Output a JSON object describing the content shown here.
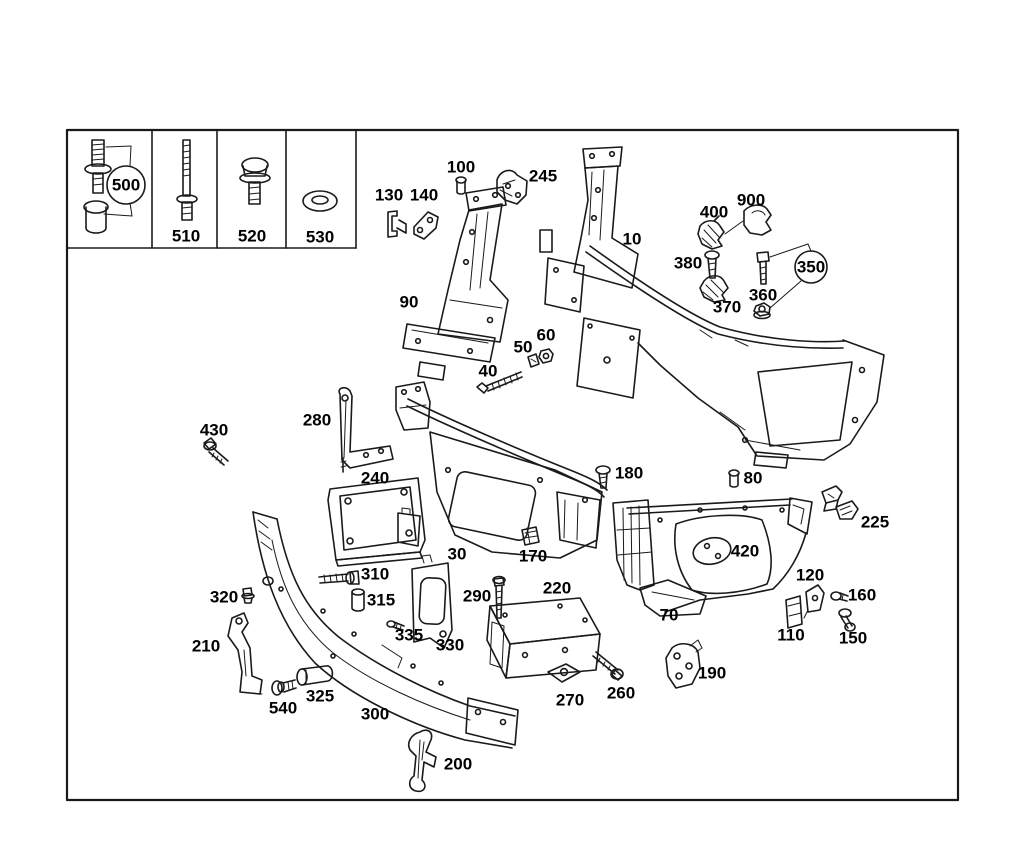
{
  "document": {
    "kind": "vehicle-parts-exploded-diagram",
    "subject": "front end / radiator support and bumper reinforcement parts"
  },
  "colors": {
    "background": "#ffffff",
    "line": "#1a1a1a",
    "accent_red": "#e5173f",
    "label_text": "#000000"
  },
  "legend": {
    "cells": [
      {
        "callout": "500",
        "icon": "stud-and-cap-nut-icon",
        "circled": true
      },
      {
        "callout": "510",
        "icon": "long-collar-bolt-icon"
      },
      {
        "callout": "520",
        "icon": "hex-flange-bolt-icon"
      },
      {
        "callout": "530",
        "icon": "washer-icon"
      }
    ]
  },
  "callouts": [
    {
      "label": "500",
      "x": 126,
      "y": 185,
      "circled": true
    },
    {
      "label": "510",
      "x": 186,
      "y": 236
    },
    {
      "label": "520",
      "x": 252,
      "y": 236
    },
    {
      "label": "530",
      "x": 320,
      "y": 237
    },
    {
      "label": "100",
      "x": 461,
      "y": 167
    },
    {
      "label": "245",
      "x": 543,
      "y": 176
    },
    {
      "label": "130",
      "x": 389,
      "y": 195
    },
    {
      "label": "140",
      "x": 424,
      "y": 195
    },
    {
      "label": "10",
      "x": 632,
      "y": 239
    },
    {
      "label": "90",
      "x": 409,
      "y": 302
    },
    {
      "label": "900",
      "x": 751,
      "y": 200
    },
    {
      "label": "400",
      "x": 714,
      "y": 212
    },
    {
      "label": "380",
      "x": 688,
      "y": 263
    },
    {
      "label": "370",
      "x": 727,
      "y": 307
    },
    {
      "label": "360",
      "x": 763,
      "y": 295
    },
    {
      "label": "350",
      "x": 811,
      "y": 267,
      "circled": true
    },
    {
      "label": "50",
      "x": 523,
      "y": 347
    },
    {
      "label": "60",
      "x": 546,
      "y": 335
    },
    {
      "label": "40",
      "x": 488,
      "y": 371
    },
    {
      "label": "430",
      "x": 214,
      "y": 430
    },
    {
      "label": "280",
      "x": 317,
      "y": 420
    },
    {
      "label": "240",
      "x": 375,
      "y": 478
    },
    {
      "label": "180",
      "x": 629,
      "y": 473
    },
    {
      "label": "80",
      "x": 753,
      "y": 478
    },
    {
      "label": "225",
      "x": 875,
      "y": 522
    },
    {
      "label": "420",
      "x": 745,
      "y": 551
    },
    {
      "label": "30",
      "x": 457,
      "y": 554
    },
    {
      "label": "170",
      "x": 533,
      "y": 556
    },
    {
      "label": "310",
      "x": 375,
      "y": 574
    },
    {
      "label": "320",
      "x": 224,
      "y": 597
    },
    {
      "label": "315",
      "x": 381,
      "y": 600
    },
    {
      "label": "290",
      "x": 477,
      "y": 596
    },
    {
      "label": "220",
      "x": 557,
      "y": 588
    },
    {
      "label": "70",
      "x": 669,
      "y": 615
    },
    {
      "label": "120",
      "x": 810,
      "y": 575
    },
    {
      "label": "110",
      "x": 791,
      "y": 635
    },
    {
      "label": "160",
      "x": 862,
      "y": 595
    },
    {
      "label": "150",
      "x": 853,
      "y": 638
    },
    {
      "label": "335",
      "x": 409,
      "y": 635
    },
    {
      "label": "330",
      "x": 450,
      "y": 645
    },
    {
      "label": "210",
      "x": 206,
      "y": 646
    },
    {
      "label": "540",
      "x": 283,
      "y": 708
    },
    {
      "label": "325",
      "x": 320,
      "y": 696
    },
    {
      "label": "300",
      "x": 375,
      "y": 714
    },
    {
      "label": "260",
      "x": 621,
      "y": 693
    },
    {
      "label": "270",
      "x": 570,
      "y": 700
    },
    {
      "label": "190",
      "x": 712,
      "y": 673
    },
    {
      "label": "200",
      "x": 458,
      "y": 764
    }
  ]
}
